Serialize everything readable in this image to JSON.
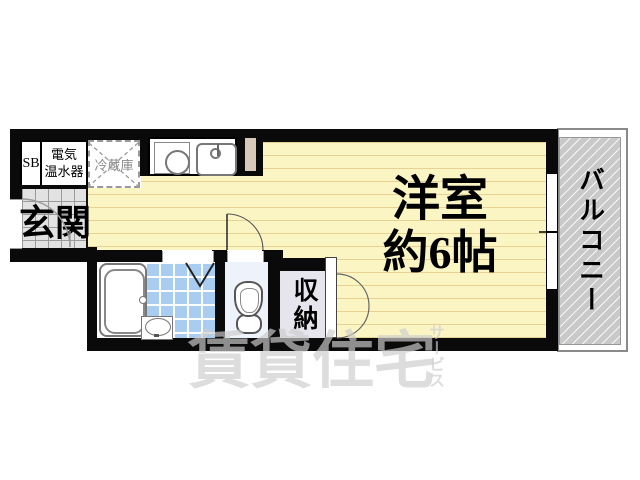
{
  "rooms": {
    "main": {
      "line1": "洋室",
      "line2": "約6帖"
    },
    "entrance": "玄関",
    "storage": "収納",
    "balcony": "バルコニー"
  },
  "fixtures": {
    "shoe_box": "SB",
    "water_heater": {
      "line1": "電気",
      "line2": "温水器"
    },
    "refrigerator": "冷蔵庫"
  },
  "watermark": {
    "main": "賃貸住宅",
    "sub": "サービス"
  },
  "colors": {
    "wall": "#0a0a0a",
    "floor": "#fbf5c4",
    "floor_stripe": "#e7d193",
    "bath_tile": "#a9cdf0",
    "entrance_tile": "#e2e2e2",
    "closet": "#e6e4ec",
    "toilet_room": "#edf2fb",
    "balcony_hatch": "#c9c9c9",
    "pillar": "#d8c8ba",
    "watermark": "#cdcdcd"
  }
}
